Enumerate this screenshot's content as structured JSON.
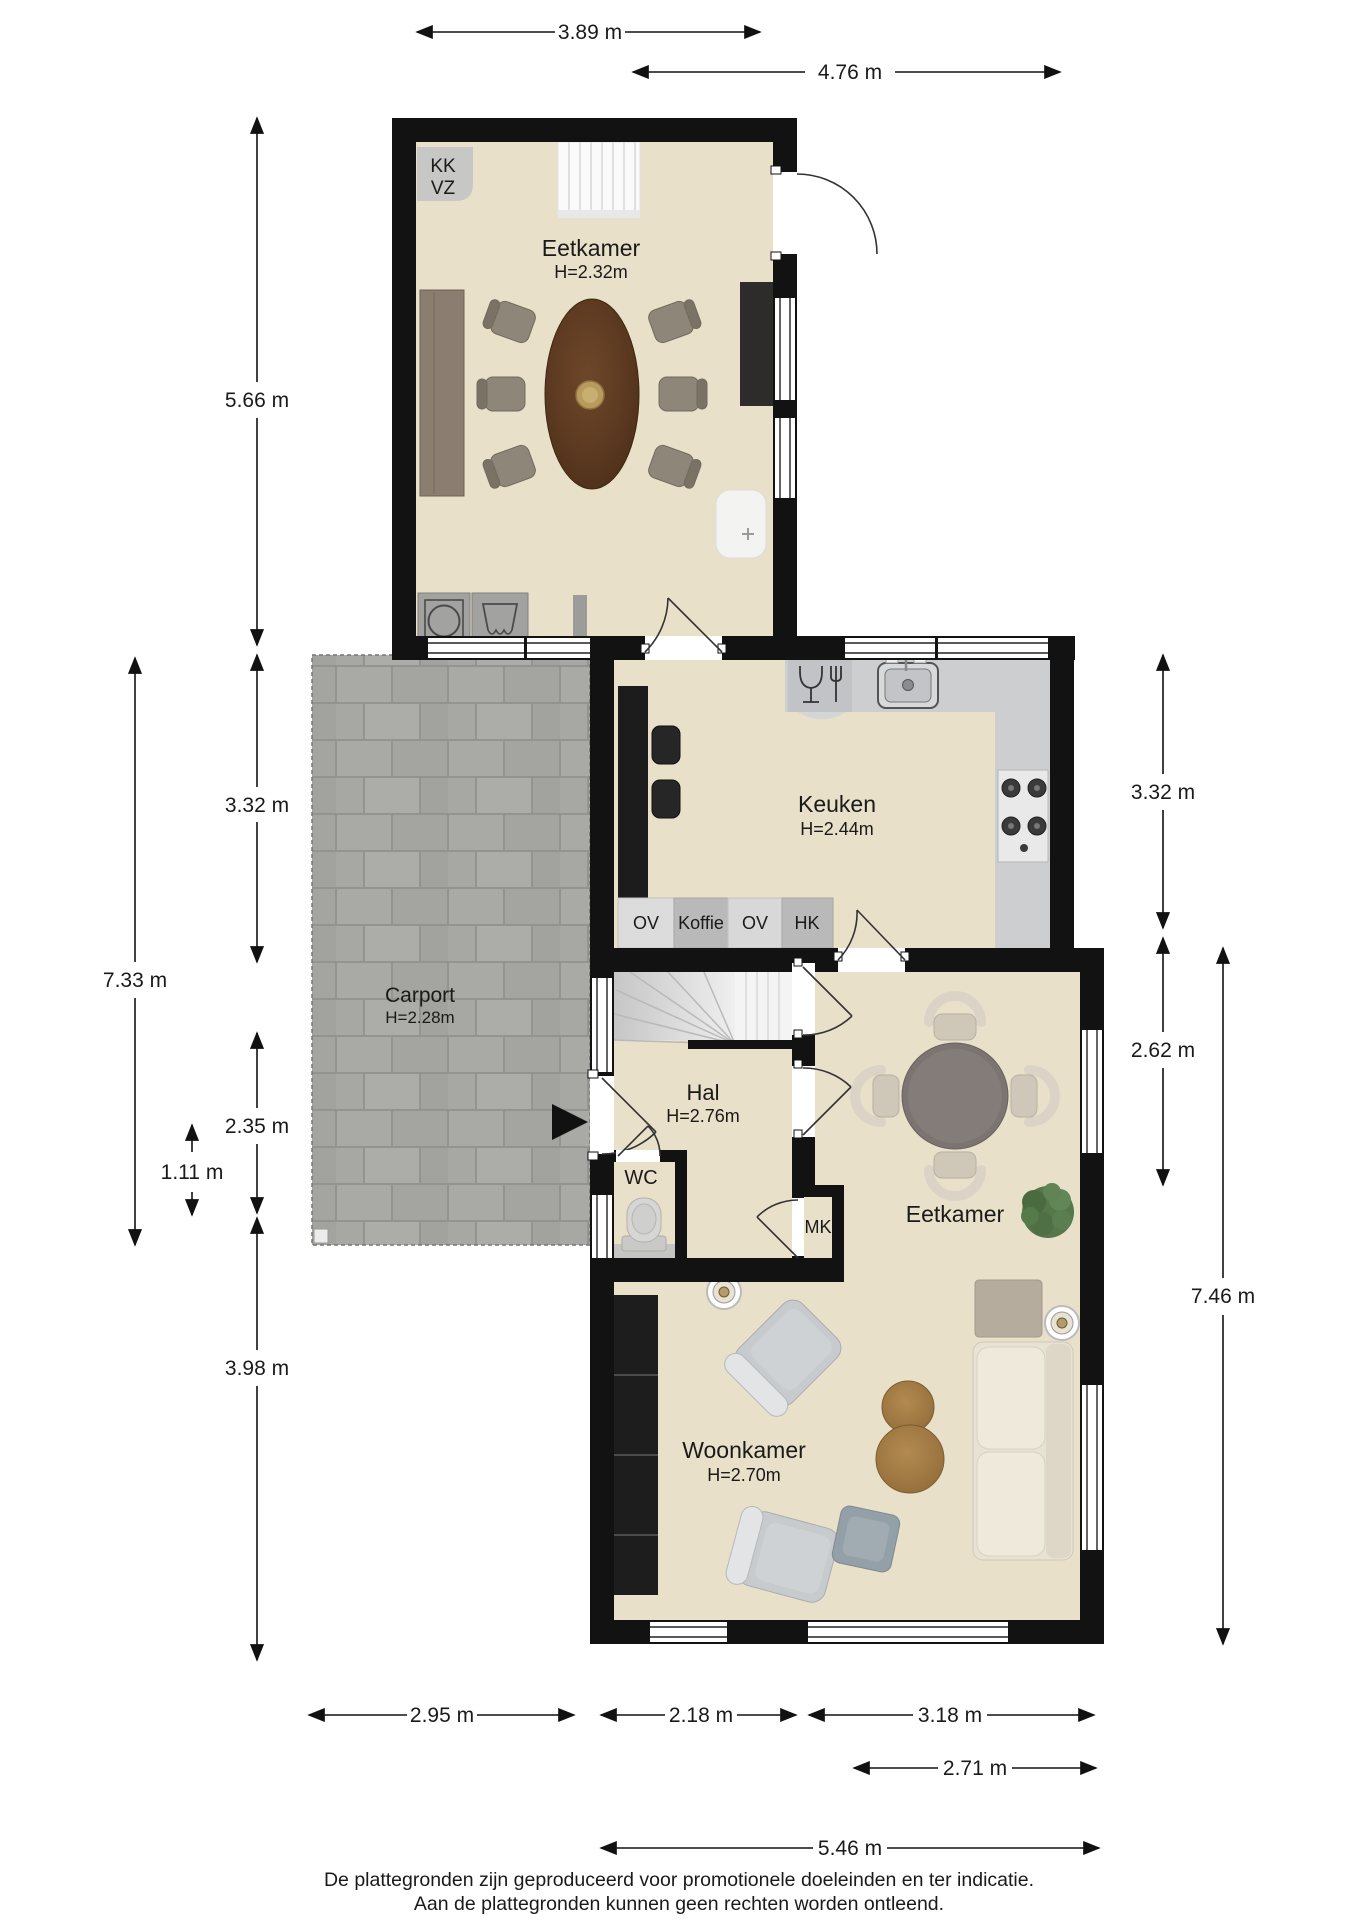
{
  "footer": {
    "line1": "De plattegronden zijn geproduceerd voor promotionele doeleinden en ter indicatie.",
    "line2": "Aan de plattegronden kunnen geen rechten worden ontleend."
  },
  "dimensions": {
    "top": {
      "d1": "3.89 m",
      "d2": "4.76 m"
    },
    "left": {
      "d1": "5.66 m",
      "d2": "3.32 m",
      "d3": "7.33 m",
      "d4": "2.35 m",
      "d5": "1.11 m",
      "d6": "3.98 m"
    },
    "right": {
      "d1": "3.32 m",
      "d2": "2.62 m",
      "d3": "7.46 m"
    },
    "bottom": {
      "d1": "2.95 m",
      "d2": "2.18 m",
      "d3": "3.18 m",
      "d4": "2.71 m",
      "d5": "5.46 m"
    }
  },
  "rooms": {
    "eetkamer_boven": {
      "name": "Eetkamer",
      "height": "H=2.32m"
    },
    "keuken": {
      "name": "Keuken",
      "height": "H=2.44m"
    },
    "carport": {
      "name": "Carport",
      "height": "H=2.28m"
    },
    "hal": {
      "name": "Hal",
      "height": "H=2.76m"
    },
    "wc": {
      "name": "WC"
    },
    "mk": {
      "name": "MK"
    },
    "eetkamer": {
      "name": "Eetkamer"
    },
    "woonkamer": {
      "name": "Woonkamer",
      "height": "H=2.70m"
    }
  },
  "annotations": {
    "kk": "KK",
    "vz": "VZ",
    "ov1": "OV",
    "koffie": "Koffie",
    "ov2": "OV",
    "hk": "HK"
  },
  "colors": {
    "wall": "#121212",
    "floor": "#e9e0ca",
    "paver": "#a7a7a3",
    "counter": "#cdced0"
  }
}
